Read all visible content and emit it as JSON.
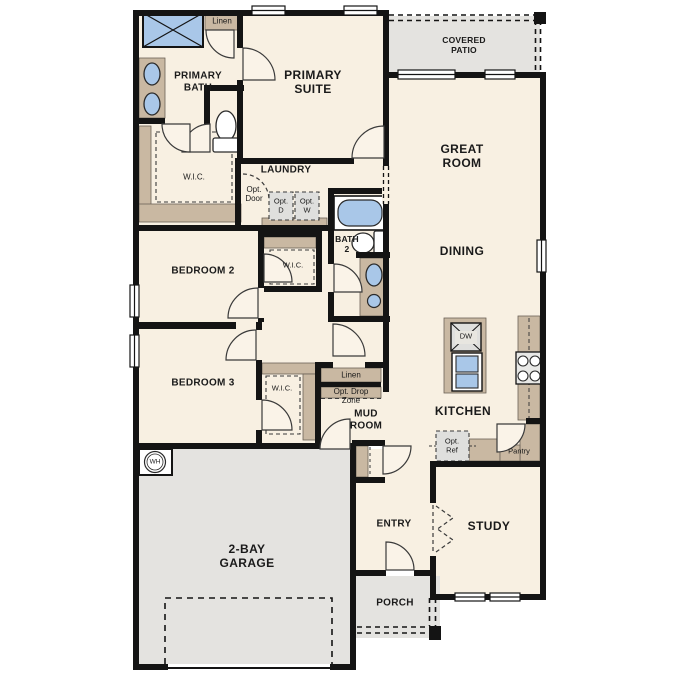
{
  "plan_title": "single-story floor plan",
  "colors": {
    "floor": "#f8f0e2",
    "wall": "#141414",
    "cabinet_tan": "#c9b8a2",
    "fixture_blue": "#a9c7e8",
    "exterior_gray": "#e4e3e0",
    "appliance_gray": "#dfdfdd",
    "background": "#ffffff"
  },
  "labels": {
    "covered_patio": "COVERED\nPATIO",
    "primary_bath": "PRIMARY\nBATH",
    "linen_bath": "Linen",
    "primary_suite": "PRIMARY\nSUITE",
    "great_room": "GREAT\nROOM",
    "wic_primary": "W.I.C.",
    "laundry": "LAUNDRY",
    "opt_door": "Opt.\nDoor",
    "opt_d": "Opt.\nD",
    "opt_w": "Opt.\nW",
    "bath2": "BATH\n2",
    "dining": "DINING",
    "bedroom2": "BEDROOM 2",
    "wic_bed2": "W.I.C.",
    "bedroom3": "BEDROOM 3",
    "wic_bed3": "W.I.C.",
    "linen_mud": "Linen",
    "opt_drop_zone": "Opt. Drop\nZone",
    "mud_room": "MUD\nROOM",
    "kitchen": "KITCHEN",
    "dw": "DW",
    "opt_ref": "Opt.\nRef",
    "pantry": "Pantry",
    "wh": "WH",
    "garage": "2-BAY\nGARAGE",
    "entry": "ENTRY",
    "study": "STUDY",
    "porch": "PORCH"
  }
}
